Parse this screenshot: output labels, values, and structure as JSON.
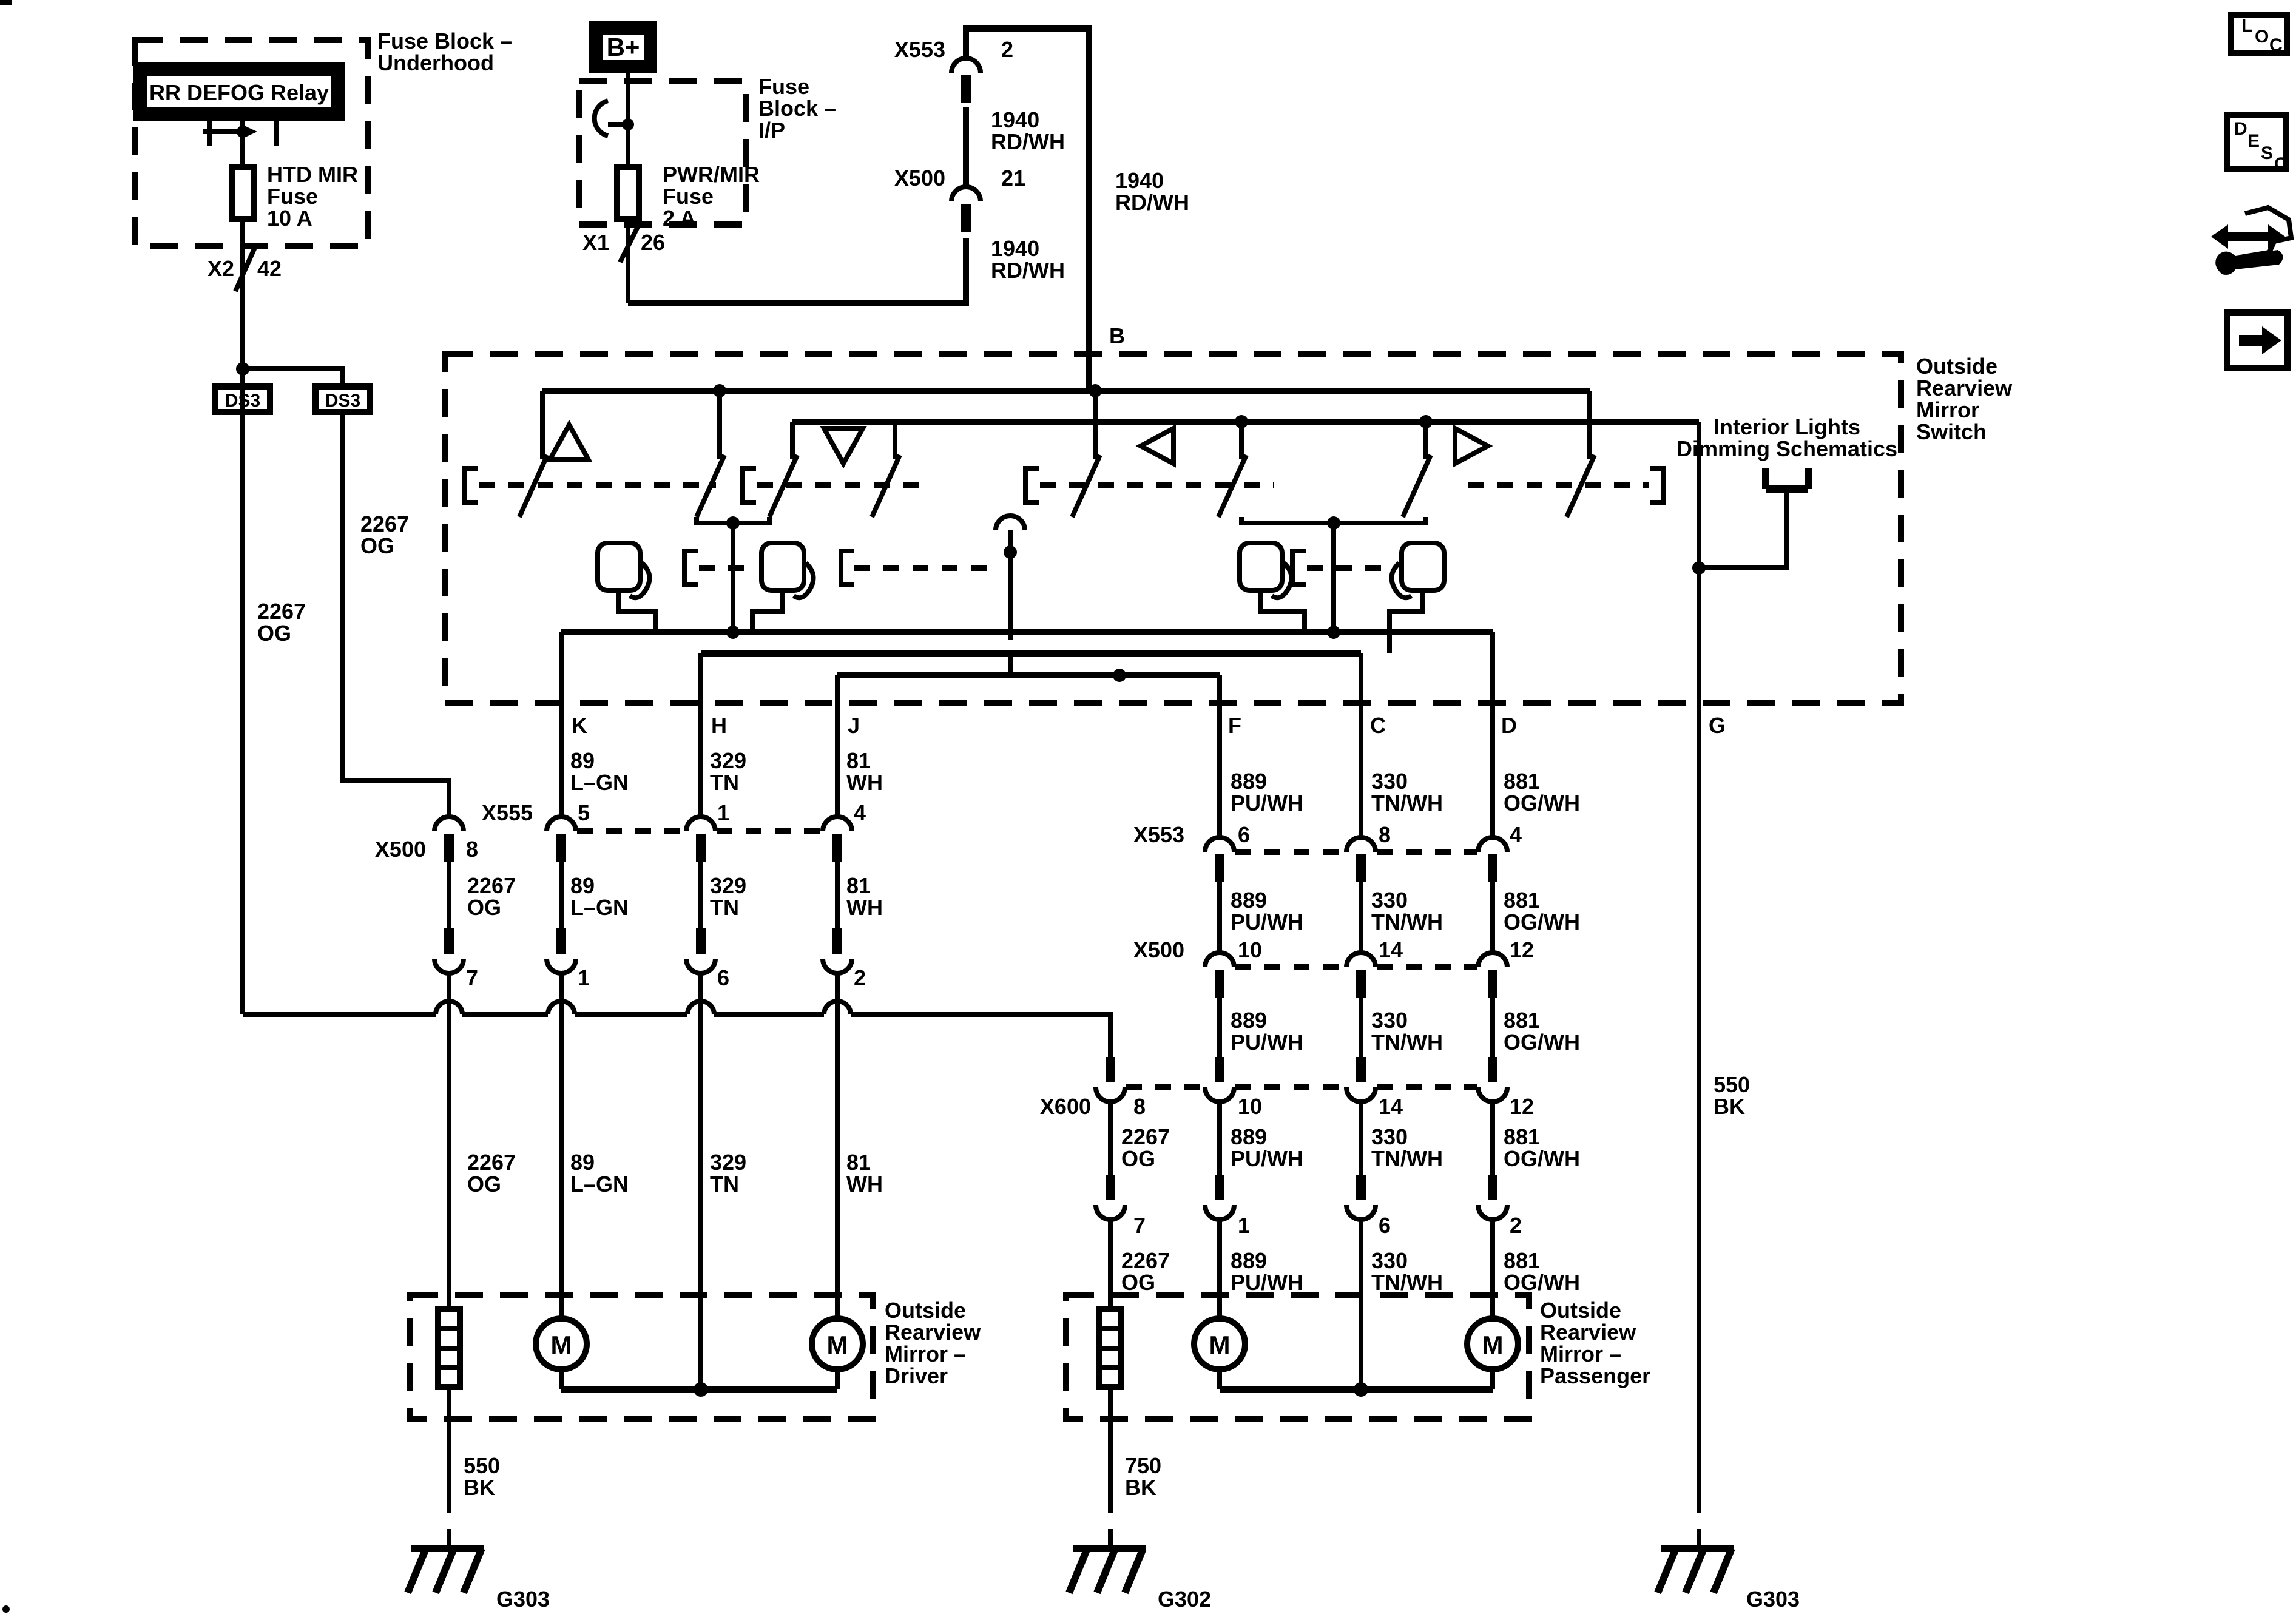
{
  "underhood": {
    "title1": "Fuse Block –",
    "title2": "Underhood",
    "relay": "RR DEFOG Relay",
    "fuse1": "HTD MIR",
    "fuse2": "Fuse",
    "fuse3": "10 A",
    "conn": "X2",
    "pin": "42"
  },
  "ip": {
    "bplus": "B+",
    "title1": "Fuse",
    "title2": "Block –",
    "title3": "I/P",
    "fuse1": "PWR/MIR",
    "fuse2": "Fuse",
    "fuse3": "2 A",
    "conn": "X1",
    "pin": "26"
  },
  "feed": {
    "x553": "X553",
    "x553_pin": "2",
    "w1a": "1940",
    "w1b": "RD/WH",
    "x500": "X500",
    "x500_pin": "21",
    "w2a": "1940",
    "w2b": "RD/WH",
    "w3a": "1940",
    "w3b": "RD/WH",
    "b": "B"
  },
  "ds3": {
    "left": "DS3",
    "right": "DS3"
  },
  "og": {
    "a": "2267",
    "b": "OG"
  },
  "switchbox": {
    "t1": "Outside",
    "t2": "Rearview",
    "t3": "Mirror",
    "t4": "Switch",
    "int1": "Interior Lights",
    "int2": "Dimming Schematics"
  },
  "cols": {
    "k": {
      "l": "K",
      "a": "89",
      "b": "L–GN"
    },
    "h": {
      "l": "H",
      "a": "329",
      "b": "TN"
    },
    "j": {
      "l": "J",
      "a": "81",
      "b": "WH"
    },
    "f": {
      "l": "F",
      "a": "889",
      "b": "PU/WH"
    },
    "c": {
      "l": "C",
      "a": "330",
      "b": "TN/WH"
    },
    "d": {
      "l": "D",
      "a": "881",
      "b": "OG/WH"
    },
    "g": "G"
  },
  "rows": {
    "x555": {
      "n": "X555",
      "p1": "5",
      "p2": "1",
      "p3": "4"
    },
    "x500l": {
      "n": "X500",
      "p": "8"
    },
    "lowl": {
      "p1": "7",
      "p2": "1",
      "p3": "6",
      "p4": "2"
    },
    "x553": {
      "n": "X553",
      "p1": "6",
      "p2": "8",
      "p3": "4"
    },
    "x500r": {
      "n": "X500",
      "p1": "10",
      "p2": "14",
      "p3": "12"
    },
    "x600": {
      "n": "X600",
      "p1": "8",
      "p2": "10",
      "p3": "14",
      "p4": "12"
    },
    "lowr": {
      "p1": "7",
      "p2": "1",
      "p3": "6",
      "p4": "2"
    }
  },
  "grounds": {
    "left": {
      "w1": "550",
      "w2": "BK",
      "g": "G303"
    },
    "mid": {
      "w1": "750",
      "w2": "BK",
      "g": "G302"
    },
    "right": {
      "w1": "550",
      "w2": "BK",
      "g": "G303"
    }
  },
  "driver": {
    "t1": "Outside",
    "t2": "Rearview",
    "t3": "Mirror –",
    "t4": "Driver",
    "m": "M"
  },
  "passenger": {
    "t1": "Outside",
    "t2": "Rearview",
    "t3": "Mirror –",
    "t4": "Passenger",
    "m": "M"
  },
  "icons": {
    "loc1": "L",
    "loc2": "O",
    "loc3": "C",
    "desc1": "D",
    "desc2": "E",
    "desc3": "S",
    "desc4": "C"
  }
}
